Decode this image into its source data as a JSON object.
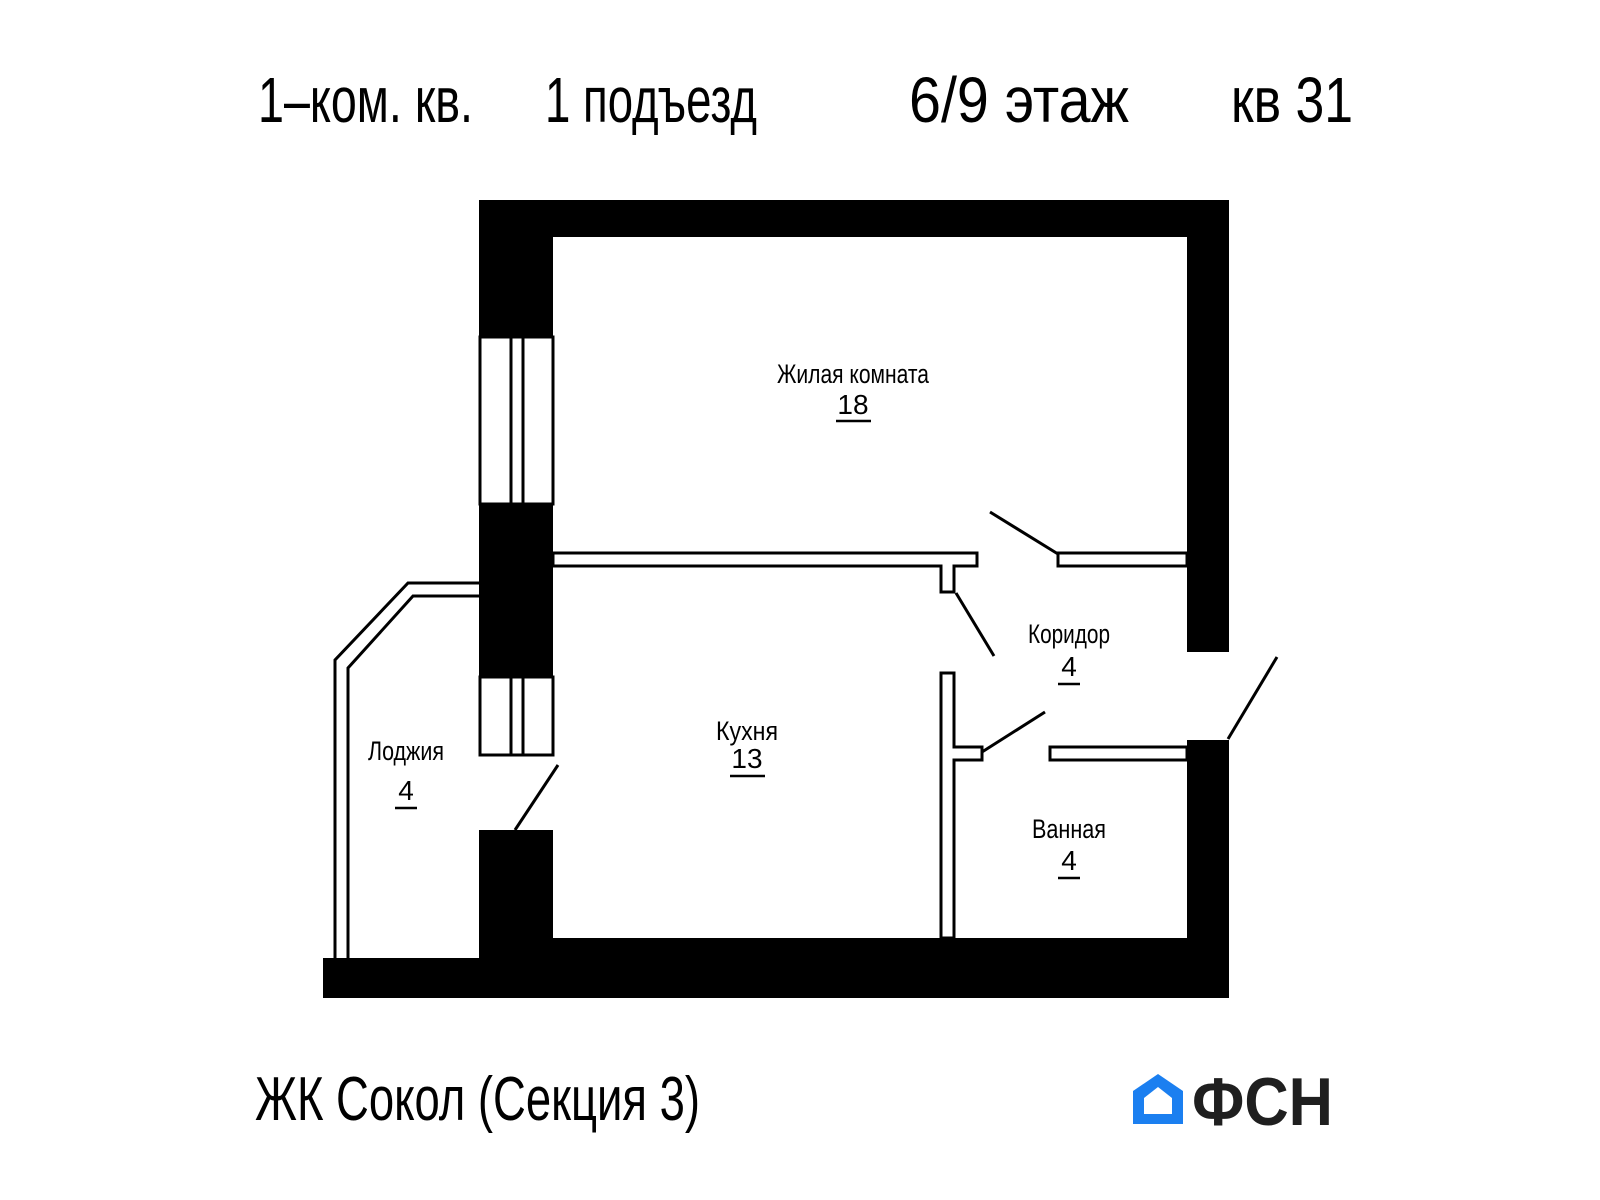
{
  "header": {
    "apartment_type": "1–ком. кв.",
    "entrance": "1 подъезд",
    "floor": "6/9 этаж",
    "apartment": "кв 31"
  },
  "rooms": [
    {
      "name": "Жилая комната",
      "area": "18"
    },
    {
      "name": "Кухня",
      "area": "13"
    },
    {
      "name": "Коридор",
      "area": "4"
    },
    {
      "name": "Ванная",
      "area": "4"
    },
    {
      "name": "Лоджия",
      "area": "4"
    }
  ],
  "footer": {
    "project": "ЖК Сокол (Секция 3)"
  },
  "logo": {
    "text": "ФСН"
  },
  "colors": {
    "walls": "#000000",
    "background": "#ffffff",
    "logo_blue": "#1b7ff0",
    "logo_text": "#1f1f1f"
  }
}
